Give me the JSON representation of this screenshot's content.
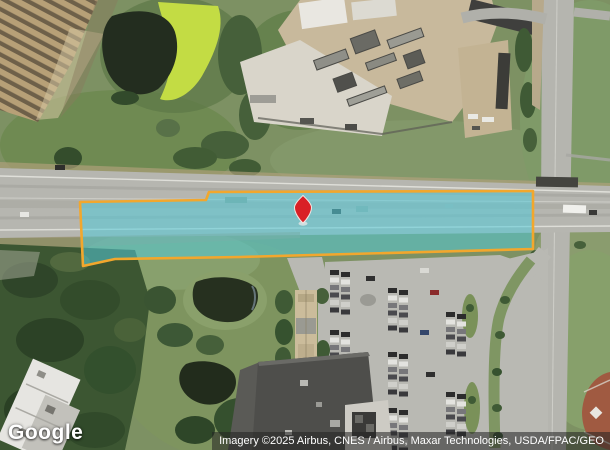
{
  "map": {
    "logo_text": "Google",
    "attribution_text": "Imagery ©2025 Airbus, CNES / Airbus, Maxar Technologies, USDA/FPAC/GEO"
  },
  "parcel": {
    "fill_color": "#52CBD9",
    "fill_opacity": "0.55",
    "border_color": "#F2A72D"
  },
  "marker": {
    "fill_color": "#D92026",
    "outline_color": "#F3E7E3"
  }
}
